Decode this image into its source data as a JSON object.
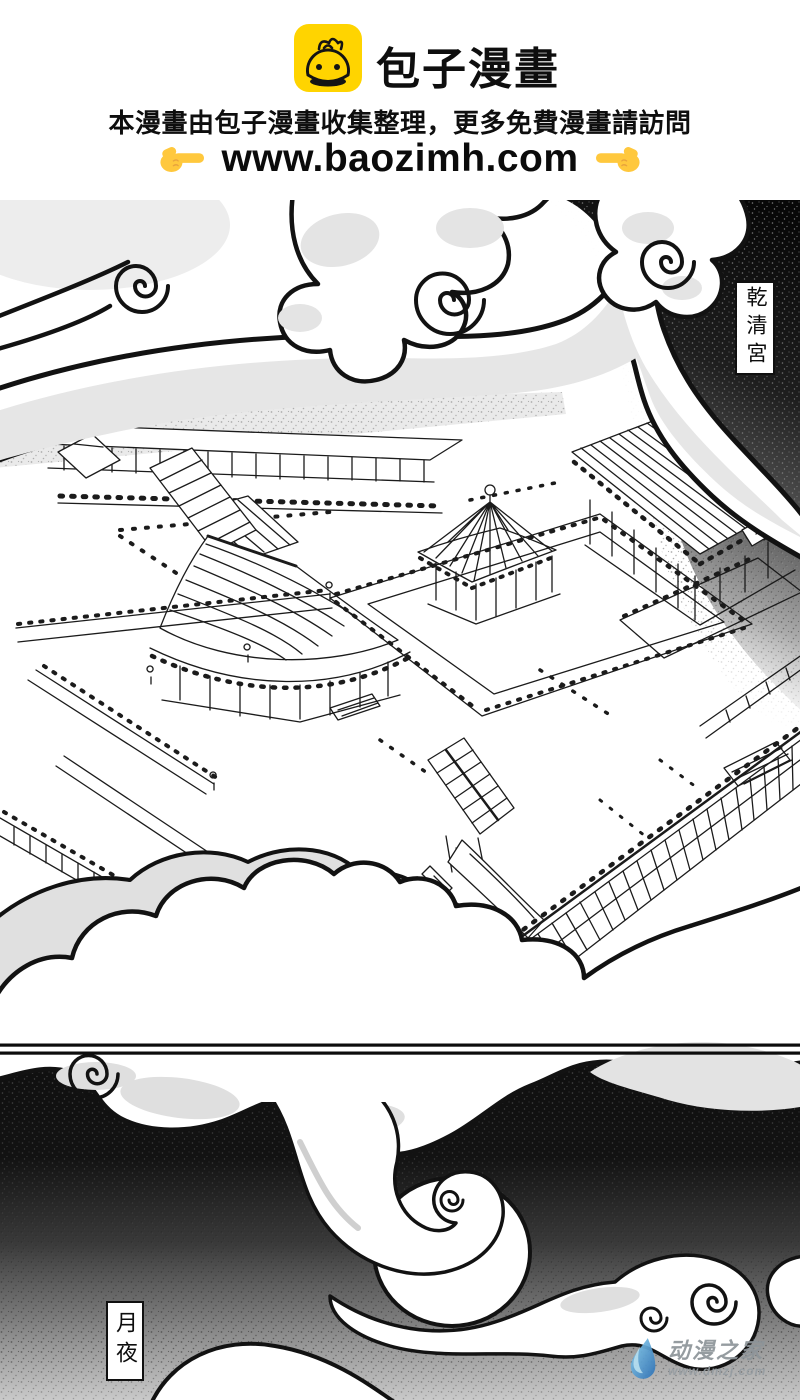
{
  "header": {
    "site_title": "包子漫畫",
    "notice": "本漫畫由包子漫畫收集整理，更多免費漫畫請訪問",
    "url": "www.baozimh.com",
    "logo_color": "#FFD400",
    "hand_color": "#FFC83D"
  },
  "panels": {
    "panel1_label": "乾清宮",
    "panel2_label": "月夜"
  },
  "watermark": {
    "name": "动漫之家",
    "url": "www.dmzj.com",
    "text_color": "#8d9499",
    "drop_color_light": "#8ed4f2",
    "drop_color_dark": "#2a6fb5"
  },
  "colors": {
    "ink": "#151515",
    "cloud_shade": "#e2e2e2",
    "night_top": "#0d0d0d",
    "night_bottom": "#c6c6c6"
  }
}
